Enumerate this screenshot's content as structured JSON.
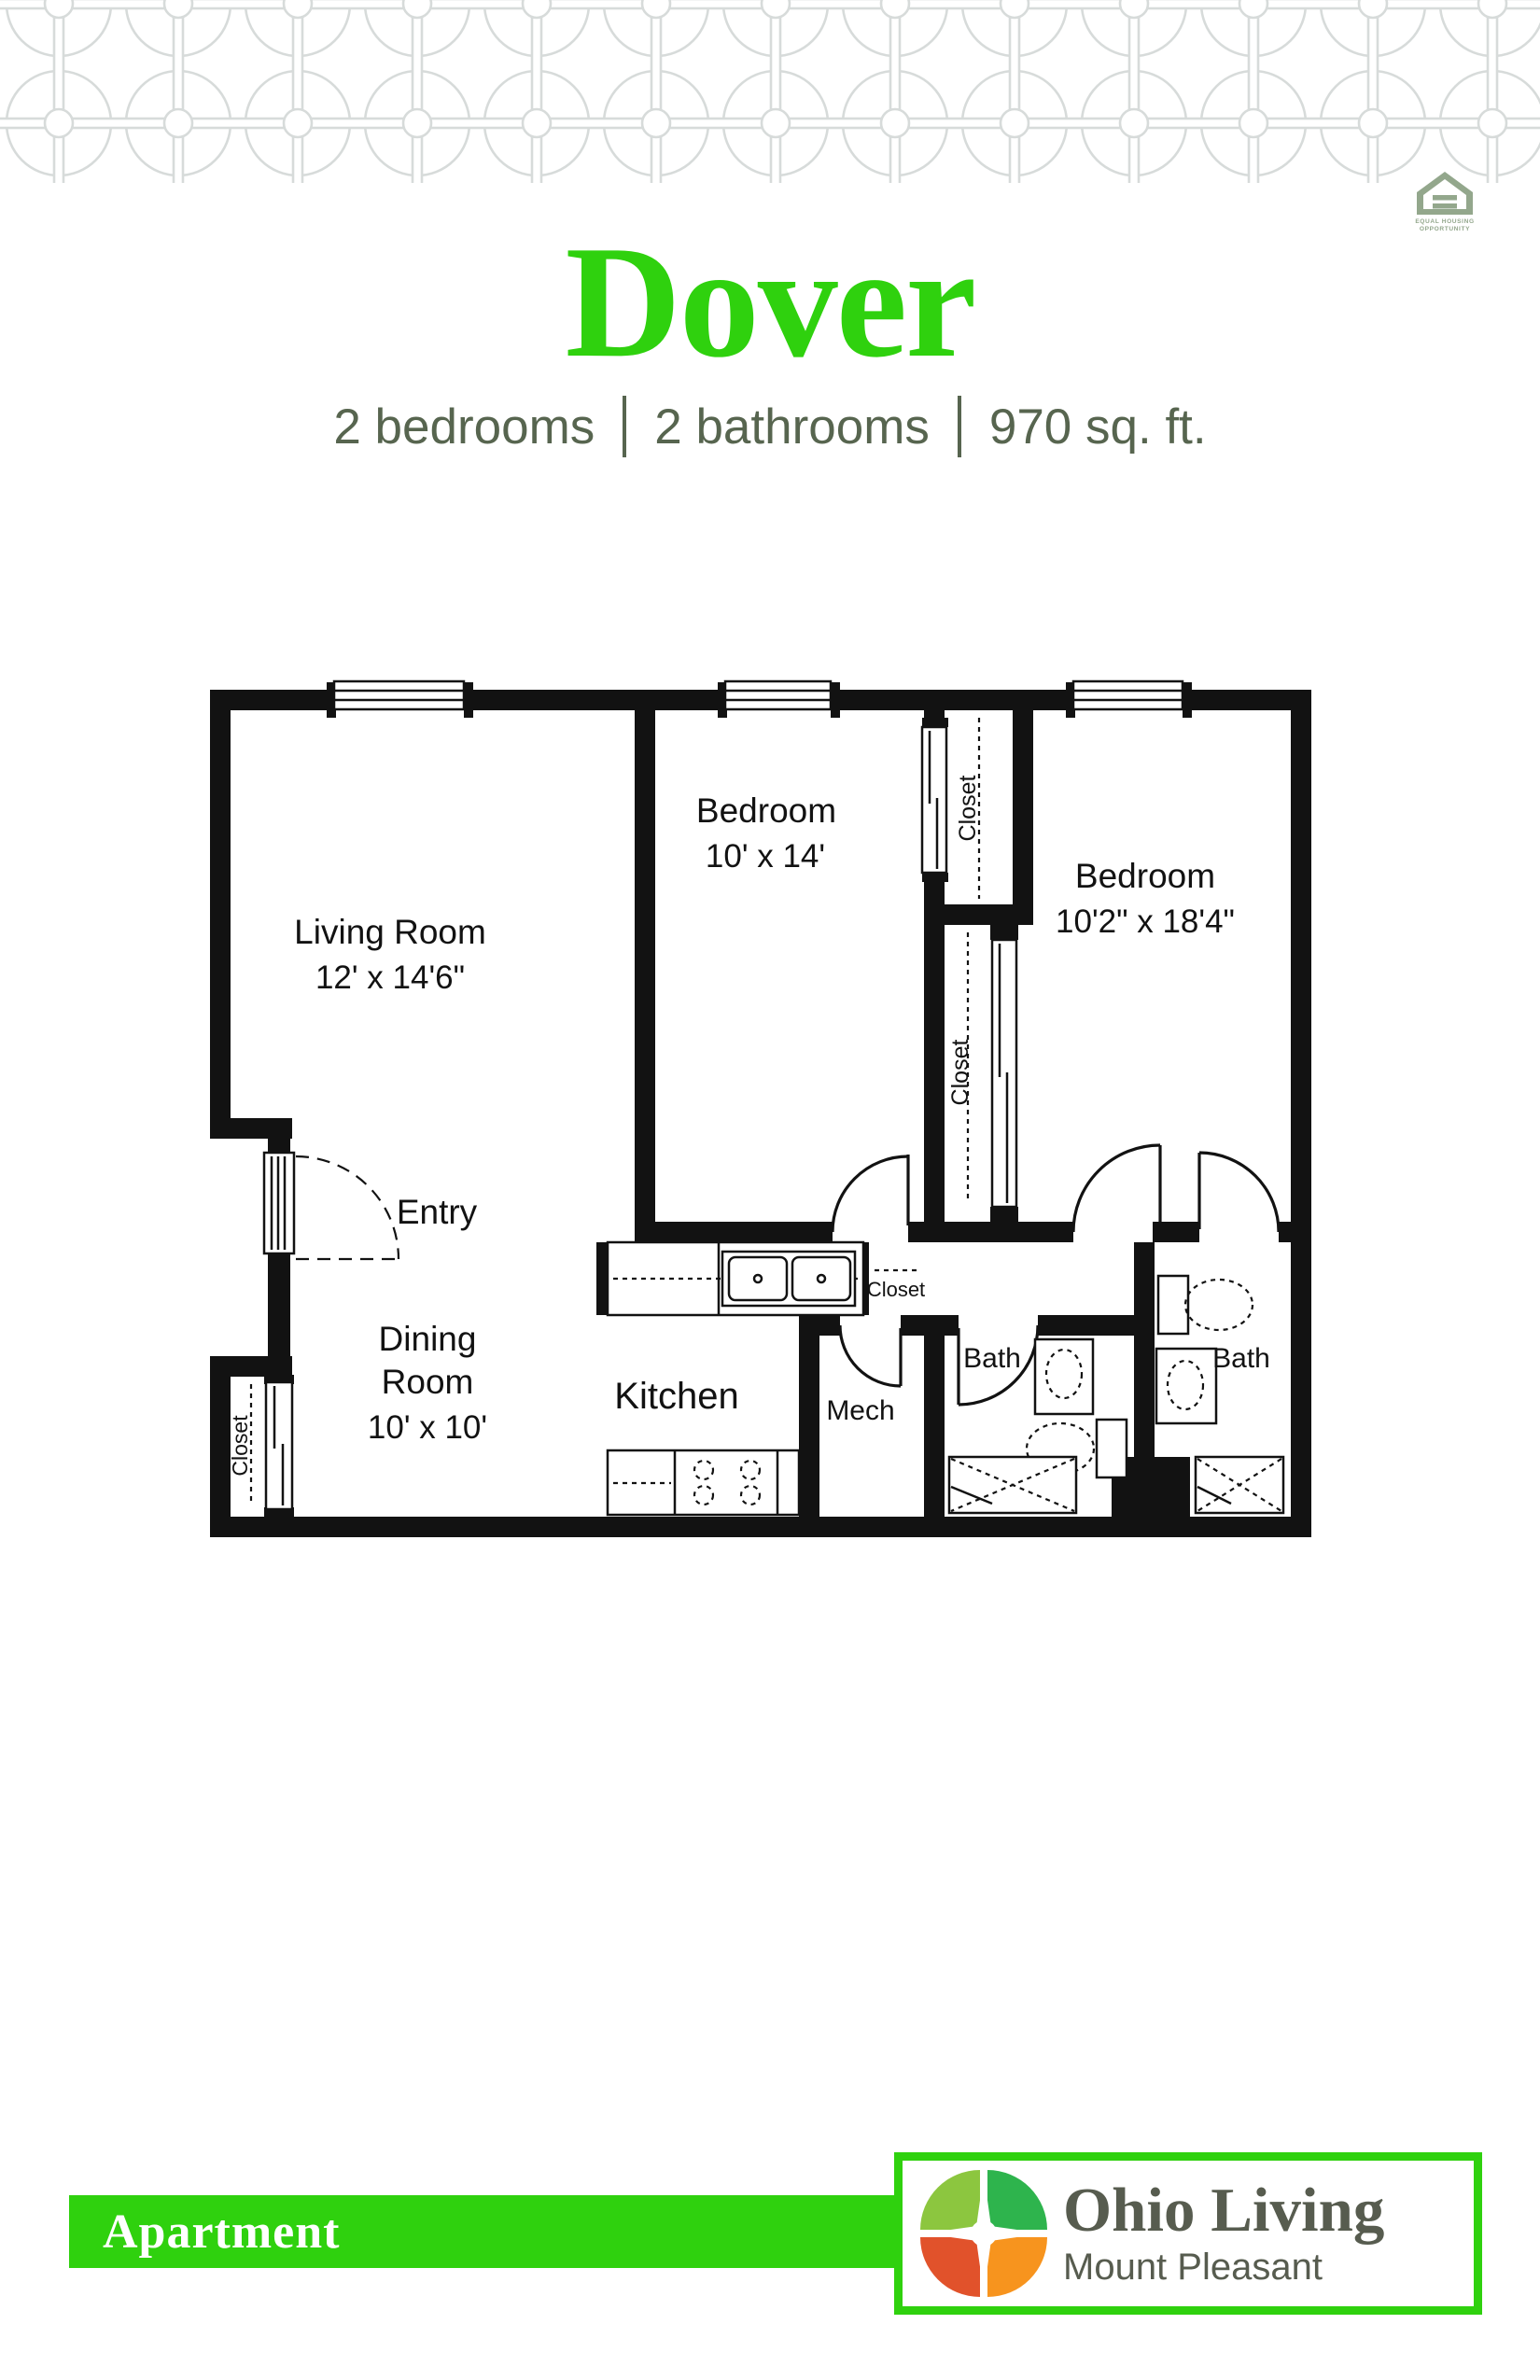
{
  "header": {
    "eho_line1": "EQUAL HOUSING",
    "eho_line2": "OPPORTUNITY"
  },
  "title": "Dover",
  "subtitle": {
    "bedrooms": "2 bedrooms",
    "bathrooms": "2 bathrooms",
    "area": "970 sq. ft."
  },
  "plan": {
    "living": {
      "name": "Living Room",
      "dims": "12' x 14'6\""
    },
    "bedroom1": {
      "name": "Bedroom",
      "dims": "10' x 14'"
    },
    "bedroom2": {
      "name": "Bedroom",
      "dims": "10'2\" x 18'4\""
    },
    "dining": {
      "line1": "Dining",
      "line2": "Room",
      "dims": "10' x 10'"
    },
    "entry": "Entry",
    "kitchen": "Kitchen",
    "mech": "Mech",
    "bath1": "Bath",
    "bath2": "Bath",
    "closets": {
      "bedroom1_closet": "Closet",
      "bedroom2_closet": "Closet",
      "entry_closet": "Closet",
      "hall_closet": "Closet"
    }
  },
  "footer": {
    "tag": "Apartment",
    "brand": "Ohio Living",
    "community": "Mount Pleasant"
  },
  "colors": {
    "accent_green": "#2FD10E",
    "eho_sage": "#93A78C",
    "subtitle_green_gray": "#57654F",
    "plan_ink": "#121212",
    "pattern_gray": "#D7DBDA",
    "brand_text": "#575C4F",
    "emblem_top_left": "#8CC63F",
    "emblem_top_right": "#2EB44D",
    "emblem_bottom_left": "#E1522B",
    "emblem_bottom_right": "#F7941E"
  }
}
